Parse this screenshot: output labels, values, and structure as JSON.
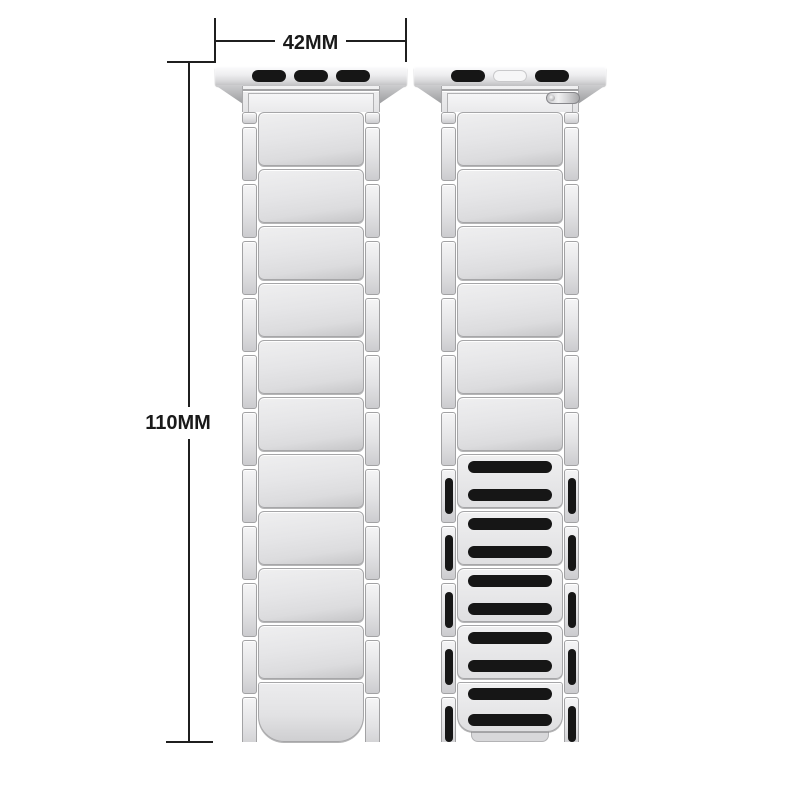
{
  "page": {
    "background": "#ffffff"
  },
  "annotations": {
    "width_label": "42MM",
    "height_label": "110MM"
  },
  "bands": {
    "front": {
      "view": "front",
      "adapter_slots": [
        "black",
        "black",
        "black"
      ],
      "plain_segments": 10,
      "magnet_segments": 0,
      "magnet_tail": false,
      "tail_tab": false,
      "release_pin": false,
      "side_links_per_rail": 11,
      "magnet_side_slots_per_rail": 0
    },
    "back": {
      "view": "back",
      "adapter_slots": [
        "black",
        "white",
        "black"
      ],
      "plain_segments": 6,
      "magnet_segments": 4,
      "magnet_tail": true,
      "tail_tab": true,
      "release_pin": true,
      "side_links_per_rail": 11,
      "magnet_side_slots_per_rail": 5
    }
  },
  "colors": {
    "dimension_line": "#1f1f1f",
    "label_text": "#1a1a1a",
    "band_silver_light": "#f2f2f3",
    "band_silver_mid": "#e3e3e5",
    "band_silver_dark": "#c7c7c9",
    "magnet_slot_black": "#161616",
    "adapter_slot_white": "#f6f6f7"
  }
}
